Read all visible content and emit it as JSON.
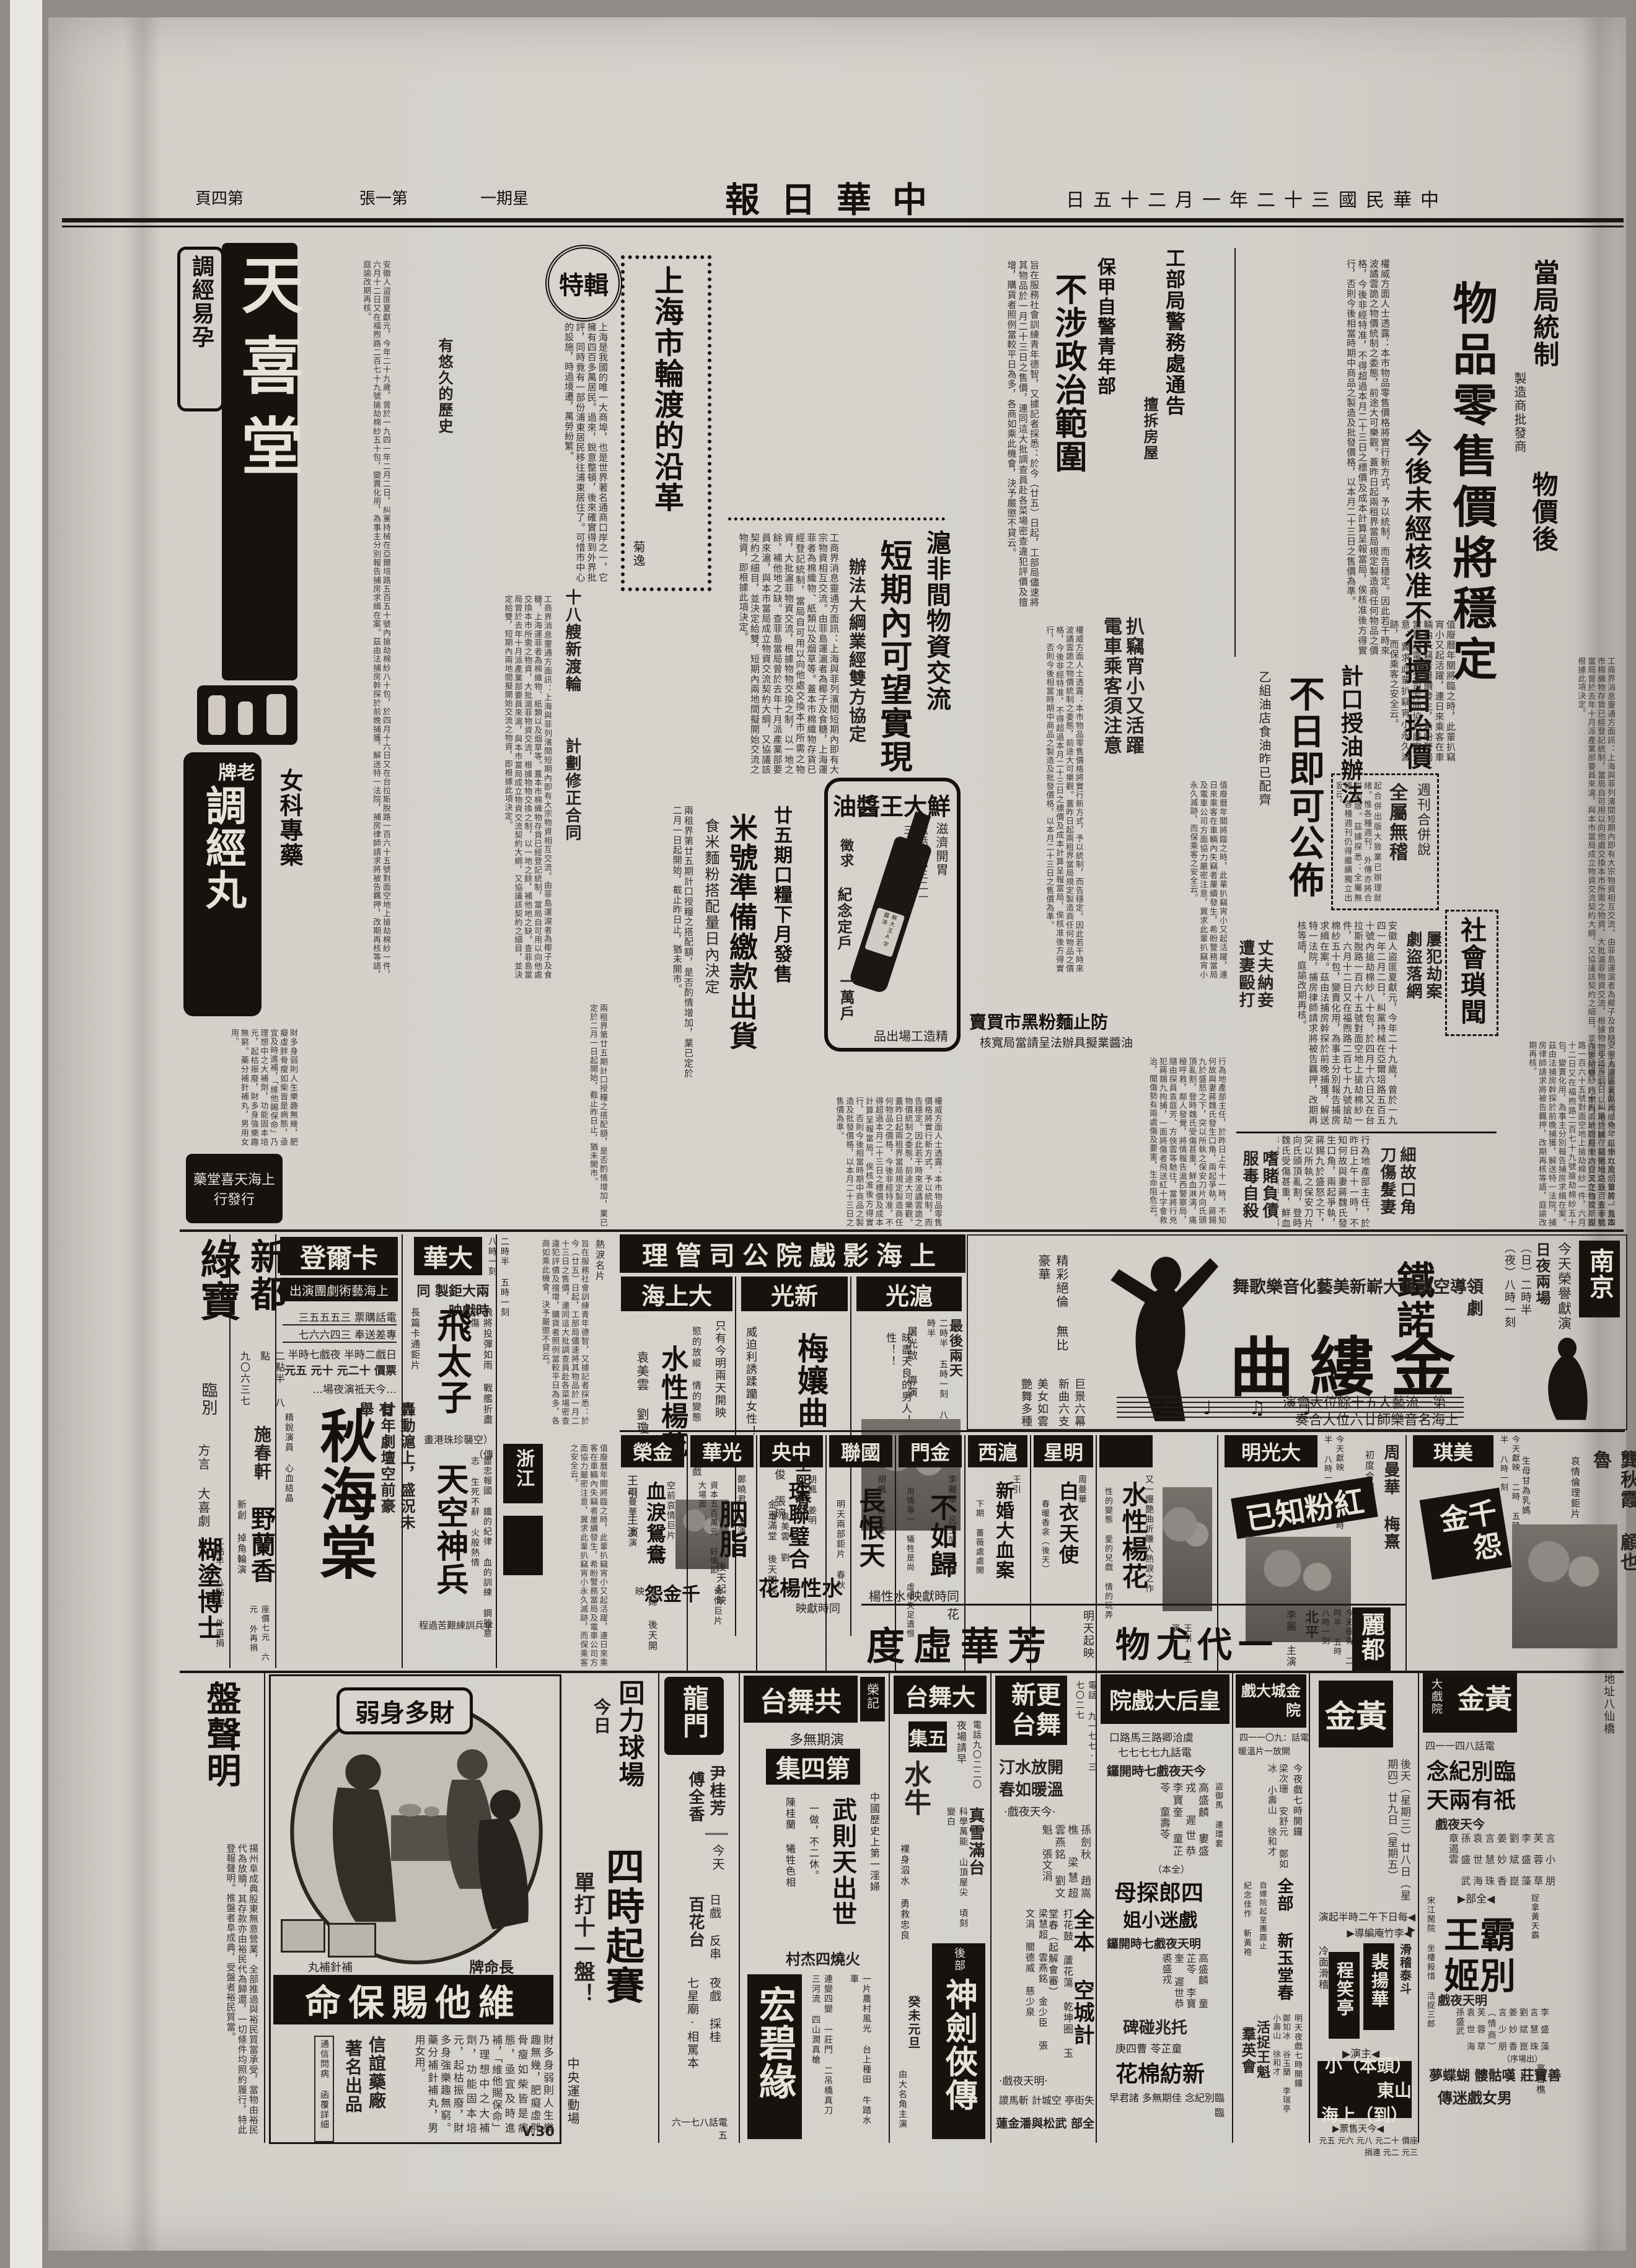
{
  "masthead": {
    "title": "中華日報",
    "date": "中華民國三十二年一月二十五日",
    "weekday": "星期一",
    "edition": "第一張",
    "page": "第四頁"
  },
  "lead": {
    "k1": "當局統制",
    "k_small": "製造商批發商",
    "k2": "物價後",
    "headline": "物品零售價將穩定",
    "subhead": "今後未經核准不得擅自抬價",
    "body": "權威方面人士透露：本市物品零售價格將實行新方式，予以統制，而告穩定。因此若干時來波譎雲詭之物價統制之委態，前途大可樂觀。蓋昨日起兩租界當局規定製造商任何物品之價格，今後非經特准，不得超過本月二十三日之標價及成本計算呈報當局，俟核准後方得實行，否則今後相當時期中商品之製造及批發價格，以本月二十三日之售價為準。"
  },
  "oil": {
    "kicker": "計口授油辦法",
    "headline": "不日即可公佈",
    "subhead": "乙組油店食油昨已配齊"
  },
  "weekly": {
    "t1": "週刊合併說",
    "t2": "全屬無稽",
    "body": "起合併出版大致業已辦理就緒。惟各種週刊，外傳亦將合併出版。茲據探悉：全屬無稽，各種週刊仍得繼續獨立出版云。"
  },
  "pick": {
    "h1": "扒竊宵小又活躍",
    "h2": "電車乘客須注意",
    "body": "值廢曆年關將臨之時，此輩扒竊宵小又起活躍，連日來乘客在車輛內失竊者屢續發生，希盼警務當局及電車公司方面協力嚴密注意，冀求此輩扒竊宵小永久滅跡，而保乘客之安全云。"
  },
  "baojia": {
    "kicker": "保甲自警青年部",
    "headline": "不涉政治範圍",
    "body": "旨在服務社會訓練青年德智，又據記者採悉：於今（廿五）日起，工部局儘速將其物品於一月二十三日之售價，連同這大批調查員赴各菜場密查違犯評價及擅增，購貨者照例當較平日為多，各商如乘此機會，決予嚴懲不貸云。"
  },
  "swo": {
    "h": "工部局警務處通告",
    "sub": "擅拆房屋"
  },
  "ferry": {
    "badge": "特輯",
    "title": "上海市輪渡的沿革",
    "author": "菊逸",
    "s1": "十八艘新渡輪",
    "s2": "計劃修正合同",
    "s3": "有悠久的歷史",
    "body": "上海是我國的唯一大商埠，也是世界著名通商口岸之一，它擁有四百多萬居民。過來，銳意整頓，後來確實得到外界批評，同時竟有一部份浦東居民移往浦東居住了。可惜市中心的設施，時過境遷，萬勞紛繁。"
  },
  "exch": {
    "h1": "滬非間物資交流",
    "h2": "短期內可望實現",
    "sub": "辦法大綱業經雙方協定",
    "body": "工商界消息靈通方面訊：上海與菲列濱間短期內即有大宗物資相互交流。由菲島運滬者為椰子及食糖，上海運菲者為棉織物、紙類以及烟草等。蓋本市棉織物存貨已經登記統制，當局自可用以向他處交換本市所需之物資，大批滬菲物資交流，根據物物交換之制，以一地之餘，補他地之缺。查菲島當局曾於去年十月派產業部要員來滬，與本市當局成立物資交流契約大綱，又協議該契約之細目，並決定給雙，短期內兩地間擬開始交流之物資，即根據此項決定。"
  },
  "rice": {
    "kicker": "廿五期口糧下月發售",
    "headline": "米號準備繳款出貨",
    "sub": "食米麵粉搭配量日內決定",
    "body": "兩租界第廿五期計口授糧之搭配額，是否酌情增加，業已定於二月一日起開始，截止昨日止，猶未開市。"
  },
  "flour": {
    "h": "防止麵粉黑市買賣",
    "sub": "油醬業擬具辦法呈請當局寬核"
  },
  "soy": {
    "brand": "鮮大王醬油",
    "tag": "滋濟開胃",
    "c1": "徵求",
    "c2": "紀念定戶",
    "c3": "一萬戶",
    "phone": "電話三七三二一三",
    "label": "鮮大王A字醬油",
    "maker": "精造工場出品"
  },
  "society": {
    "header": "社會瑣聞",
    "i1a": "屢犯劫案",
    "i1b": "劇盜落網",
    "i2a": "丈夫納妾",
    "i2b": "遭妻毆打",
    "i3a": "細故口角",
    "i3b": "刀傷髮妻",
    "i4a": "嗜賭負債",
    "i4b": "服毒自殺",
    "body": "安徽人盜匪夏獻元，今年二十九歲，曾於一九四一年二月二日，糾黨持械在亞爾培路五百五十號內搶劫棉紗八十包，於四月十六日又在台拉斯脫路一百六十五號對面空地上搶劫棉紗一件，六月十二日又在福煦路二百七十九號搶劫棉紗五十包，變賣化用，為事主分別報告捕房求緝在案。茲由法捕房幹探於前晚捕獲，解送特一法院，捕房律師請求將被告羈押，改期再核等語，庭諭改期再核。",
    "body2": "行為地產部主任，於昨日上午十一時，不知何故與妻蔣魏氏發生口角，兩起爭執，蔣錫九於盛怒之下，突以所執之保安刀片向氏頭頂亂割，登時魏氏受傷甚重，鮮血淋漓，痛極呼救，鄰人發覺，將情報告滬西警察局，隨由探員袁庭芳、方俠雲等馳往，當將行兇犯蔣錫九拘捕，一面將傷者飛送紅十字會救治，聞傷勢有兩處傷及要害，生命阻危云。"
  },
  "tianxi": {
    "store": "天喜堂",
    "slogan": "調經易孕",
    "product": "調經丸",
    "brand": "老牌",
    "category": "女科專藥",
    "footer": "上海天喜堂藥行發行"
  },
  "ent": {
    "banner": "上海影戲院公司管理"
  },
  "dsh": {
    "name": "大上海",
    "note": "只有今明兩天開映",
    "tag": "慾的放縱 情的變態 愛的兒戲",
    "film": "水性楊花",
    "stars": "袁美雲 劉瓊",
    "star2": "王引 主演",
    "coming": "千金怨",
    "coming2": "後天起映"
  },
  "xg": {
    "name": "新光",
    "tag": "威迫利誘蹂躪女性！",
    "film": "梅孃曲",
    "stars": "王熙春",
    "stars2": "嚴俊 張琬",
    "coming": "水性楊花",
    "coming2": "同時獻映",
    "extra": "袁美雲 劉瓊"
  },
  "hg": {
    "name": "滬光",
    "note": "最後兩天",
    "times": "二時半 五時一刻 八時半",
    "credit": "屠光啟 導演",
    "tag": "昧盡天良的男人！殺了愛性！！",
    "coming": "同時獻映·水性楊花"
  },
  "nanjing": {
    "name": "南京",
    "sched1": "今天榮譽獻演",
    "sched2": "日夜兩場",
    "sched3": "（日）二時半",
    "sched4": "（夜）八時一刻",
    "presenter": "鐵諾",
    "tagline": "領導空前偉大嶄新美藝化音樂歌舞劇",
    "title": "金縷曲",
    "l1": "第一流藝人五十餘位大會演",
    "l2": "上海名音樂師廿六位大合奏",
    "s1": "巨景六幕 新曲六支",
    "s2": "美女如雲 艷舞多種",
    "s3": "精彩絕倫 無比豪華"
  },
  "row2": {
    "c1": {
      "name": "金榮",
      "film": "血淚鴛鴦",
      "stars": "周曼華 主演",
      "note": "空前哀情巨片",
      "coming": "蕩婦 後天開映"
    },
    "c2": {
      "name": "光華",
      "film": "胭脂",
      "stars": "鄭曉君 主演",
      "note": "奇情巨片",
      "coming": "資本五百萬元 好情節 大場面"
    },
    "c3": {
      "name": "中央",
      "film": "珠聯璧合",
      "stars": "胡楓 姜明",
      "coming": "金玉滿堂 後天開映"
    },
    "c4": {
      "name": "國聯",
      "film": "長恨天",
      "stars": "胡楓 呂玉堃",
      "coming": "明天兩部鉅片 春秋"
    },
    "c5": {
      "name": "金門",
      "film": "不如歸",
      "stars": "李麗華 呂玉堃 主演",
      "note": "用情專一 犧牲是尚 虛榮失足遺恨"
    },
    "c6": {
      "name": "滬西",
      "film": "新婚大血案",
      "stars": "王引",
      "note": "開映巨片",
      "coming": "下期 薔薇處處開"
    },
    "c7": {
      "name": "明星",
      "film": "白衣天使",
      "stars": "周曼華",
      "coming": "春暖香衾（後天）"
    },
    "c8": {
      "film": "水性楊花",
      "stars": "王引 主演",
      "note": "又一慢艷曲折賺人熱淚之作",
      "tag": "性的變態 愛的兒戲 情的玩弄"
    },
    "c9": {
      "name": "大光明",
      "film": "紅粉知已",
      "stars": "周曼華 梅熹",
      "note": "初度合作",
      "times": "今天獻映 二時 五時半 八時一刻"
    },
    "c10": {
      "name": "美琪",
      "film": "千金怨",
      "stars": "龔秋霞 顧也魯",
      "note": "哀情倫理鉅片",
      "times": "今天獻映 二時 五時半 八時一刻",
      "tag": "生母甘為乳媽 親女送入地獄"
    }
  },
  "lido": {
    "name": "麗都",
    "times": "今天祗有 二時半 五時 八時一刻",
    "place": "北平",
    "star": "李麗 主演",
    "film": "一代尤物",
    "coming": "明天起映",
    "coming_film": "芳華虛度"
  },
  "lvbao": {
    "name": "綠寶",
    "n1": "臨別",
    "n2": "方言 大喜劇",
    "film": "糊塗博士",
    "note": "二點半 八點半 外再捐"
  },
  "xindu": {
    "name": "新都",
    "phone": "九〇六三七",
    "times": "二點半 八點",
    "star": "施春軒",
    "note": "新創 掉角輪演",
    "film": "野蘭香",
    "prices": "座價七元 六元 外再捐"
  },
  "carlton": {
    "name": "卡爾登",
    "troupe": "上海藝術劇團演出",
    "phone1": "電話購票 三五五五三",
    "phone2": "專差送奉 三四六六七",
    "times": "日戲二時半 夜戲七時半",
    "prices": "票價 十二元 十元 五元",
    "note": "…今天祗演夜場…",
    "t1": "轟動滬上，盛況未有",
    "t2": "廿年劇壇空前豪舉！",
    "film": "秋海棠",
    "cast": "精銳演員 心血結晶"
  },
  "dahua": {
    "name": "大華",
    "times": "二時半 五時一刻 八時一刻",
    "note": "兩大鉅製 同時獻映",
    "f1": "飛太子",
    "f1a": "（空襲珍珠港畫傳）",
    "f1b": "長篇卡通鉅片",
    "f1c": "飛將投彈如雨 戰艦折盡俱傷",
    "f2": "天空神兵",
    "f2a": "傘兵訓練艱苦過程",
    "f2b": "盡忠報國 鐵的紀律 血的訓練 鋼般意志 生死不辭 火般熱情"
  },
  "strip": {
    "z1": "浙江",
    "note": "熱淚名片"
  },
  "huili": {
    "name": "回力球場",
    "when": "今日",
    "big": "四時起賽",
    "note": "單打十一盤！",
    "venue": "中央運動場"
  },
  "longmen": {
    "name": "龍門",
    "s1": "尹桂芳",
    "s2": "傅全香",
    "today": "今天",
    "day": "日戲 反串",
    "day2": "百花台",
    "night": "夜戲 採桂",
    "night2": "七星廟·相罵本",
    "phone": "電話八七一六五"
  },
  "gong": {
    "name": "共舞台",
    "owner": "榮記",
    "note": "演期無多",
    "ep": "第四集",
    "tag": "中國歷史上第一淫婦",
    "play": "武則天出世",
    "sub": "一做，不二休。",
    "cast": "陳桂蘭 犧牲色相",
    "play2": "火燒四杰村",
    "play3": "宏碧緣",
    "fx": "連變四變 一莊門 二吊橋真刀 三河流 四山澗真槍",
    "rural": "一片農村風光 台上種田 牛踏水車"
  },
  "dawu": {
    "name": "大舞台",
    "phone": "電話九〇二二〇",
    "note": "夜場請早",
    "ep": "五集",
    "fx1": "真雪滿台",
    "fx2": "科學萬能 山頂屋尖 頃刻變白",
    "play_pre": "後部",
    "play": "神劍俠傳",
    "extra": "水牛",
    "extra2": "裸身泅水 勇救忠良",
    "date": "癸未元旦",
    "extra3": "由大名角主演"
  },
  "geng": {
    "name": "更新舞台",
    "phone": "電話 九一七七·三七〇二七",
    "comfort1": "開放水汀",
    "comfort2": "溫暖如春",
    "today": "·今天夜戲·",
    "cast1": "孫劍秋 趙嵩樵 梁慧超 雲燕銘 劉文魁 張文涓",
    "play1": "全本 空城計",
    "play1b": "打花鼓 蘆花蕩 乾坤圈 玉堂春（起解會審）",
    "tmrw": "·明天夜戲·",
    "cast2": "梁慧超 雲燕銘 金少臣 張文涓 關德威 慈少泉",
    "play2": "失街亭 空城計 斬馬謖",
    "play2b": "全部 武松與潘金蓮"
  },
  "queen": {
    "name": "皇后大戲院",
    "addr": "虞洽卿路三馬路口",
    "phone": "電話九七七七七",
    "today": "今天夜戲七時開鑼",
    "cast1": "高盛麟 婁盛戎 遲世恭 李寶奎 童芷苓 童壽苓",
    "full1": "（全本）",
    "play1": "四郎探母",
    "play1b": "戲迷小姐",
    "play1c": "盜御馬 連環套",
    "tmrw": "明天夜戲七時開鑼",
    "cast2": "高盛麟 童芷苓 李寶奎 遲世恭 裘盛戎",
    "play2": "托兆碰碑",
    "coming": "童芷苓 曹四庚",
    "coming2": "新紡棉花",
    "farewell": "臨別紀念 佳期無多 諸君早臨"
  },
  "jincheng": {
    "name": "金城大戲院",
    "phone": "電話：九〇一一四",
    "note": "開放一片溫暖",
    "today": "今夜戲七時開鑼",
    "cast1": "梁次珊 安舒元 鄭如冰 小壽山 徐和才",
    "play1": "全部 新玉堂春",
    "play1b": "自嫖院起至團圓止",
    "play1c": "紀念佳作 斬黃袍",
    "tmrw": "明天夜戲七時開鑼",
    "cast2": "鄭如冰 谷玉蘭 李瑞亭 小壽山 徐和才",
    "play2": "活捉王魁",
    "play2b": "羣英會"
  },
  "gold": {
    "name": "黃金大戲院",
    "name2": "黃金",
    "sub2": "大戲院",
    "addr": "地址八仙橋",
    "phone": "電話八四一一四",
    "farewell1": "臨別紀念",
    "farewell2": "祇有兩天",
    "today": "今天夜戲",
    "cast1": "言小朋 芙蓉草 李盛藻 劉斌崑 姜妙香 言慧珠 袁世海 孫盛武 章遏雲",
    "full": "◀全部▶",
    "play1x": "霸王",
    "play1y": "別姬",
    "side1": "宋江鬧院 坐樓殺惜 活捉三郎",
    "side2": "捉拿黃天霸",
    "tmrw": "明天夜戲",
    "cast2": "李盛藻 言慧珠 劉斌崑 姜妙香 言少朋（情商）芙蓉草 袁世海 孫盛武",
    "order": "（出場序）",
    "play2": "善寶莊 嘆骷髏 蝴蝶夢",
    "play2b": "男女戲迷傳",
    "guest": "高雪樵",
    "later": "後天（星期三）廿八日（星期四）廿九日（星期五）",
    "later_t": "◀每日下午二時半起演▶",
    "dir": "◀李竹庵編導▶",
    "bill1": "滑稽泰斗",
    "bill2": "冷面滑稽",
    "star1": "程笑亭",
    "star2": "裴揚華",
    "zhu": "◀主演▶",
    "b1": "（頭本）小山東",
    "b2": "（到）上海",
    "sale": "◀今天售票▶",
    "prices": "座價 十二元 八元 六元 五元 三元 二元 連捐"
  },
  "vita": {
    "title": "財多身弱",
    "brand": "長命牌",
    "pk": "補針補丸",
    "product": "維他賜保命",
    "body": "財多身弱則人生樂趣無幾，肥癡虛胖骨瘦如柴皆是病態，亟宜及時進補，「維他賜保命」乃理想中之大補劑，功能固本培元，起枯振廢，財多身強樂趣無窮。藥分補針補丸，男用女用。",
    "maker": "信誼藥廠",
    "maker2": "著名出品",
    "note": "通信問病 函覆詳細",
    "mark": "V.30"
  },
  "pan": {
    "title": "盤聲明",
    "body": "揚州阜成典股東無意營業，全部推過與裕民質當承受，當物由裕民代為放贖，其存款亦由裕民代為歸還，一切條件均照約履行，特此登報聲明。推盤者阜成典，受盤者裕民質當。"
  }
}
